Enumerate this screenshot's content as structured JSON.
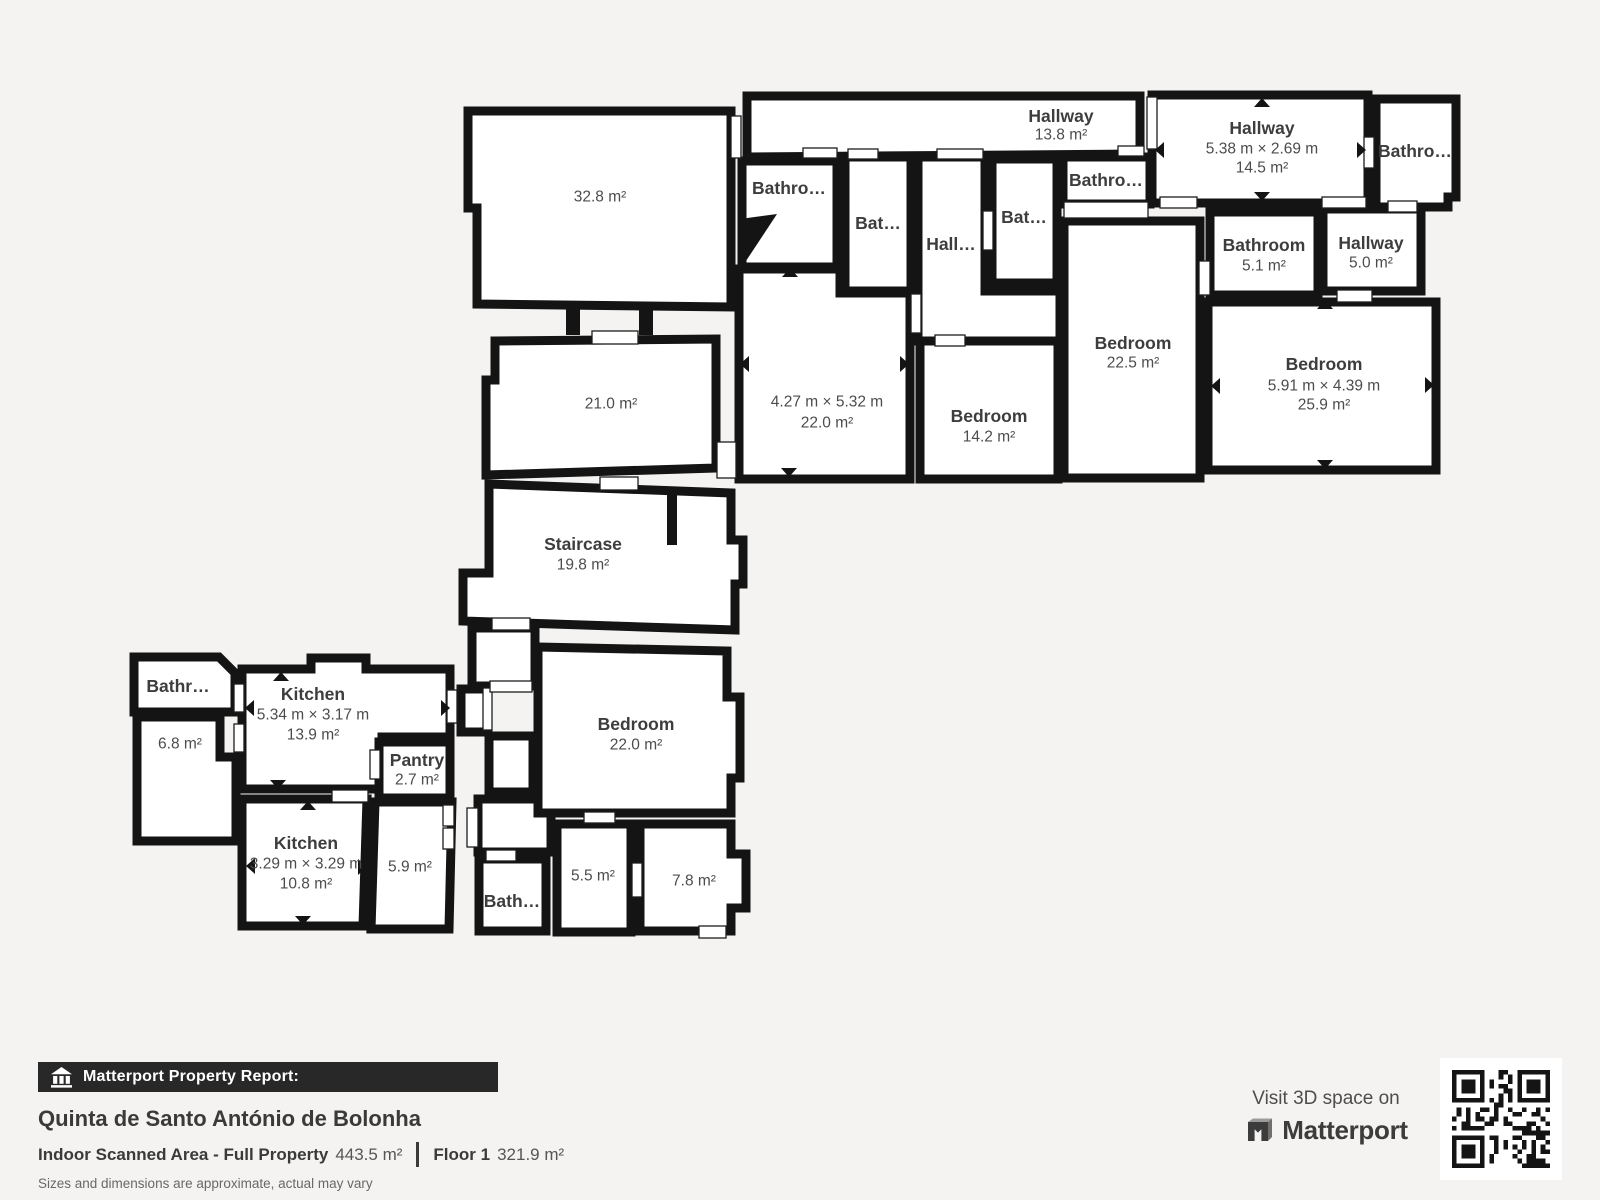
{
  "colors": {
    "background": "#f4f3f1",
    "wall": "#141414",
    "room_fill": "#ffffff",
    "room_name_text": "#3d3d3d",
    "room_size_text": "#4c4c4c",
    "bar_background": "#282828",
    "bar_text": "#ffffff",
    "qr_dark": "#141414"
  },
  "footer": {
    "bar_label": "Matterport Property Report:",
    "title": "Quinta de Santo António de Bolonha",
    "stats": {
      "area_label": "Indoor Scanned Area - Full Property",
      "area_value": "443.5 m²",
      "floor_label": "Floor 1",
      "floor_value": "321.9 m²"
    },
    "disclaimer": "Sizes and dimensions are approximate, actual may vary",
    "visit_text": "Visit 3D space on",
    "brand_name": "Matterport"
  },
  "floorplan": {
    "rooms": [
      {
        "id": "room-32-8",
        "points": "468,111 731,111 731,307 477,304 477,208 468,208",
        "lx": 600,
        "lines": [
          {
            "t": "32.8 m²",
            "y": 197
          }
        ]
      },
      {
        "id": "room-21-0",
        "points": "495,341 716,339 716,468 486,475 486,380 495,380",
        "lx": 611,
        "lines": [
          {
            "t": "21.0 m²",
            "y": 404
          }
        ]
      },
      {
        "id": "staircase",
        "points": "489,484 731,493 731,540 743,540 743,584 735,584 735,630 463,621 463,573 489,573",
        "lx": 583,
        "lines": [
          {
            "t": "Staircase",
            "y": 544,
            "b": 1
          },
          {
            "t": "19.8 m²",
            "y": 565
          }
        ]
      },
      {
        "id": "hallway-13-8",
        "points": "747,96 1140,96 1140,154 747,157",
        "lx": 1061,
        "lines": [
          {
            "t": "Hallway",
            "y": 116,
            "b": 1
          },
          {
            "t": "13.8 m²",
            "y": 135
          }
        ]
      },
      {
        "id": "bathroom-top-1",
        "points": "742,161 837,161 837,267 742,267",
        "lx": 789,
        "lines": [
          {
            "t": "Bathro…",
            "y": 188,
            "b": 1
          }
        ]
      },
      {
        "id": "bathroom-top-2",
        "points": "845,157 911,157 911,291 845,291",
        "lx": 878,
        "lines": [
          {
            "t": "Bat…",
            "y": 223,
            "b": 1
          }
        ]
      },
      {
        "id": "hall-corridor",
        "points": "918,157 985,157 985,291 1060,291 1060,341 918,341",
        "lx": 951,
        "lines": [
          {
            "t": "Hall…",
            "y": 244,
            "b": 1
          }
        ]
      },
      {
        "id": "bathroom-top-3",
        "points": "992,159 1057,159 1057,283 992,283",
        "lx": 1024,
        "lines": [
          {
            "t": "Bat…",
            "y": 217,
            "b": 1
          }
        ]
      },
      {
        "id": "bathroom-top-4",
        "points": "1063,157 1150,157 1150,204 1063,204",
        "lx": 1106,
        "lines": [
          {
            "t": "Bathro…",
            "y": 180,
            "b": 1
          }
        ]
      },
      {
        "id": "room-22-0-top",
        "points": "739,269 840,269 840,293 910,293 910,479 739,479",
        "lx": 827,
        "lines": [
          {
            "t": "4.27 m × 5.32 m",
            "y": 402
          },
          {
            "t": "22.0 m²",
            "y": 423
          }
        ]
      },
      {
        "id": "bedroom-14-2",
        "points": "920,341 1058,341 1058,479 920,479",
        "lx": 989,
        "lines": [
          {
            "t": "Bedroom",
            "y": 416,
            "b": 1
          },
          {
            "t": "14.2 m²",
            "y": 437
          }
        ]
      },
      {
        "id": "bedroom-22-5",
        "points": "1064,221 1200,221 1200,478 1064,478",
        "lx": 1133,
        "lines": [
          {
            "t": "Bedroom",
            "y": 343,
            "b": 1
          },
          {
            "t": "22.5 m²",
            "y": 363
          }
        ]
      },
      {
        "id": "hallway-14-5",
        "points": "1152,95 1368,95 1368,203 1152,203",
        "lx": 1262,
        "lines": [
          {
            "t": "Hallway",
            "y": 128,
            "b": 1
          },
          {
            "t": "5.38 m × 2.69 m",
            "y": 149
          },
          {
            "t": "14.5 m²",
            "y": 168
          }
        ]
      },
      {
        "id": "bathroom-top-right",
        "points": "1376,99 1456,99 1456,197 1448,197 1448,207 1376,207",
        "lx": 1415,
        "lines": [
          {
            "t": "Bathro…",
            "y": 151,
            "b": 1
          }
        ]
      },
      {
        "id": "bathroom-5-1",
        "points": "1210,212 1318,212 1318,295 1210,295",
        "lx": 1264,
        "lines": [
          {
            "t": "Bathroom",
            "y": 245,
            "b": 1
          },
          {
            "t": "5.1 m²",
            "y": 266
          }
        ]
      },
      {
        "id": "hallway-5-0",
        "points": "1323,209 1421,209 1421,291 1323,291",
        "lx": 1371,
        "lines": [
          {
            "t": "Hallway",
            "y": 243,
            "b": 1
          },
          {
            "t": "5.0 m²",
            "y": 263
          }
        ]
      },
      {
        "id": "bedroom-25-9",
        "points": "1208,302 1436,302 1436,470 1208,470",
        "lx": 1324,
        "lines": [
          {
            "t": "Bedroom",
            "y": 364,
            "b": 1
          },
          {
            "t": "5.91 m × 4.39 m",
            "y": 386
          },
          {
            "t": "25.9 m²",
            "y": 405
          }
        ]
      },
      {
        "id": "bathroom-left",
        "points": "134,657 219,657 235,673 235,712 134,712",
        "lx": 178,
        "lines": [
          {
            "t": "Bathr…",
            "y": 686,
            "b": 1
          }
        ]
      },
      {
        "id": "room-6-8",
        "points": "137,717 220,717 220,757 236,757 236,841 137,841",
        "lx": 180,
        "lines": [
          {
            "t": "6.8 m²",
            "y": 744
          }
        ]
      },
      {
        "id": "kitchen-13-9",
        "points": "242,669 311,669 311,658 366,658 366,669 450,669 450,737 382,737 382,789 242,789",
        "lx": 313,
        "lines": [
          {
            "t": "Kitchen",
            "y": 694,
            "b": 1
          },
          {
            "t": "5.34 m × 3.17 m",
            "y": 715
          },
          {
            "t": "13.9 m²",
            "y": 735
          }
        ]
      },
      {
        "id": "pantry",
        "points": "379,742 450,742 450,798 379,798",
        "lx": 417,
        "lines": [
          {
            "t": "Pantry",
            "y": 760,
            "b": 1
          },
          {
            "t": "2.7 m²",
            "y": 780
          }
        ]
      },
      {
        "id": "kitchen-10-8",
        "points": "242,799 367,799 363,926 242,926",
        "lx": 306,
        "lines": [
          {
            "t": "Kitchen",
            "y": 843,
            "b": 1
          },
          {
            "t": "3.29 m × 3.29 m",
            "y": 864
          },
          {
            "t": "10.8 m²",
            "y": 884
          }
        ]
      },
      {
        "id": "room-5-9",
        "points": "375,802 452,802 449,929 371,929",
        "lx": 410,
        "lines": [
          {
            "t": "5.9 m²",
            "y": 867
          }
        ]
      },
      {
        "id": "connector-a",
        "points": "472,628 535,628 535,686 472,686"
      },
      {
        "id": "connector-b",
        "points": "461,689 488,689 488,732 461,732"
      },
      {
        "id": "connector-c",
        "points": "489,736 533,736 533,792 489,792"
      },
      {
        "id": "connector-d",
        "points": "478,799 551,799 551,852 478,852"
      },
      {
        "id": "bedroom-22-0",
        "points": "538,647 727,651 727,697 740,697 740,778 731,778 731,813 538,813",
        "lx": 636,
        "lines": [
          {
            "t": "Bedroom",
            "y": 724,
            "b": 1
          },
          {
            "t": "22.0 m²",
            "y": 745
          }
        ]
      },
      {
        "id": "bathroom-bottom",
        "points": "479,859 546,859 546,931 479,931",
        "lx": 512,
        "lines": [
          {
            "t": "Bath…",
            "y": 901,
            "b": 1
          }
        ]
      },
      {
        "id": "room-5-5",
        "points": "557,824 631,824 631,932 557,932",
        "lx": 593,
        "lines": [
          {
            "t": "5.5 m²",
            "y": 876
          }
        ]
      },
      {
        "id": "room-7-8",
        "points": "640,824 731,824 731,854 746,854 746,908 731,908 731,931 640,931",
        "lx": 694,
        "lines": [
          {
            "t": "7.8 m²",
            "y": 881
          }
        ]
      }
    ],
    "stubs": [
      {
        "type": "rect",
        "x": 566,
        "y": 303,
        "w": 14,
        "h": 32
      },
      {
        "type": "rect",
        "x": 639,
        "y": 303,
        "w": 14,
        "h": 32
      },
      {
        "type": "rect",
        "x": 667,
        "y": 489,
        "w": 10,
        "h": 56
      },
      {
        "type": "poly",
        "points": "740,219 777,214 742,267"
      }
    ],
    "openings": [
      [
        731,
        116,
        10,
        42
      ],
      [
        592,
        331,
        46,
        13
      ],
      [
        803,
        148,
        34,
        10
      ],
      [
        848,
        149,
        30,
        10
      ],
      [
        937,
        149,
        46,
        10
      ],
      [
        1118,
        146,
        26,
        10
      ],
      [
        1147,
        97,
        10,
        52
      ],
      [
        1160,
        197,
        37,
        11
      ],
      [
        1322,
        197,
        44,
        11
      ],
      [
        1388,
        201,
        29,
        11
      ],
      [
        1337,
        290,
        35,
        12
      ],
      [
        1064,
        202,
        84,
        16
      ],
      [
        983,
        211,
        10,
        39
      ],
      [
        935,
        335,
        30,
        11
      ],
      [
        911,
        294,
        10,
        39
      ],
      [
        717,
        442,
        19,
        36
      ],
      [
        600,
        477,
        38,
        13
      ],
      [
        492,
        618,
        38,
        12
      ],
      [
        234,
        684,
        10,
        28
      ],
      [
        234,
        724,
        10,
        28
      ],
      [
        447,
        690,
        10,
        33
      ],
      [
        370,
        750,
        10,
        29
      ],
      [
        332,
        790,
        36,
        12
      ],
      [
        443,
        805,
        11,
        21
      ],
      [
        443,
        828,
        11,
        21
      ],
      [
        467,
        808,
        11,
        39
      ],
      [
        486,
        850,
        30,
        11
      ],
      [
        584,
        812,
        31,
        11
      ],
      [
        632,
        863,
        10,
        34
      ],
      [
        483,
        688,
        9,
        42
      ],
      [
        1364,
        137,
        10,
        31
      ],
      [
        1199,
        261,
        11,
        34
      ],
      [
        699,
        926,
        27,
        12
      ],
      [
        490,
        681,
        42,
        11
      ]
    ],
    "arrows": [
      {
        "x": 790,
        "y": 273,
        "d": "up"
      },
      {
        "x": 745,
        "y": 364,
        "d": "left"
      },
      {
        "x": 904,
        "y": 364,
        "d": "right"
      },
      {
        "x": 789,
        "y": 472,
        "d": "down"
      },
      {
        "x": 1262,
        "y": 103,
        "d": "up"
      },
      {
        "x": 1262,
        "y": 196,
        "d": "down"
      },
      {
        "x": 1160,
        "y": 150,
        "d": "left"
      },
      {
        "x": 1361,
        "y": 150,
        "d": "right"
      },
      {
        "x": 1325,
        "y": 305,
        "d": "up"
      },
      {
        "x": 1325,
        "y": 464,
        "d": "down"
      },
      {
        "x": 1216,
        "y": 386,
        "d": "left"
      },
      {
        "x": 1429,
        "y": 385,
        "d": "right"
      },
      {
        "x": 281,
        "y": 677,
        "d": "up"
      },
      {
        "x": 250,
        "y": 708,
        "d": "left"
      },
      {
        "x": 445,
        "y": 708,
        "d": "right"
      },
      {
        "x": 278,
        "y": 784,
        "d": "down"
      },
      {
        "x": 308,
        "y": 806,
        "d": "up"
      },
      {
        "x": 251,
        "y": 866,
        "d": "left"
      },
      {
        "x": 362,
        "y": 867,
        "d": "right"
      },
      {
        "x": 303,
        "y": 920,
        "d": "down"
      }
    ]
  }
}
